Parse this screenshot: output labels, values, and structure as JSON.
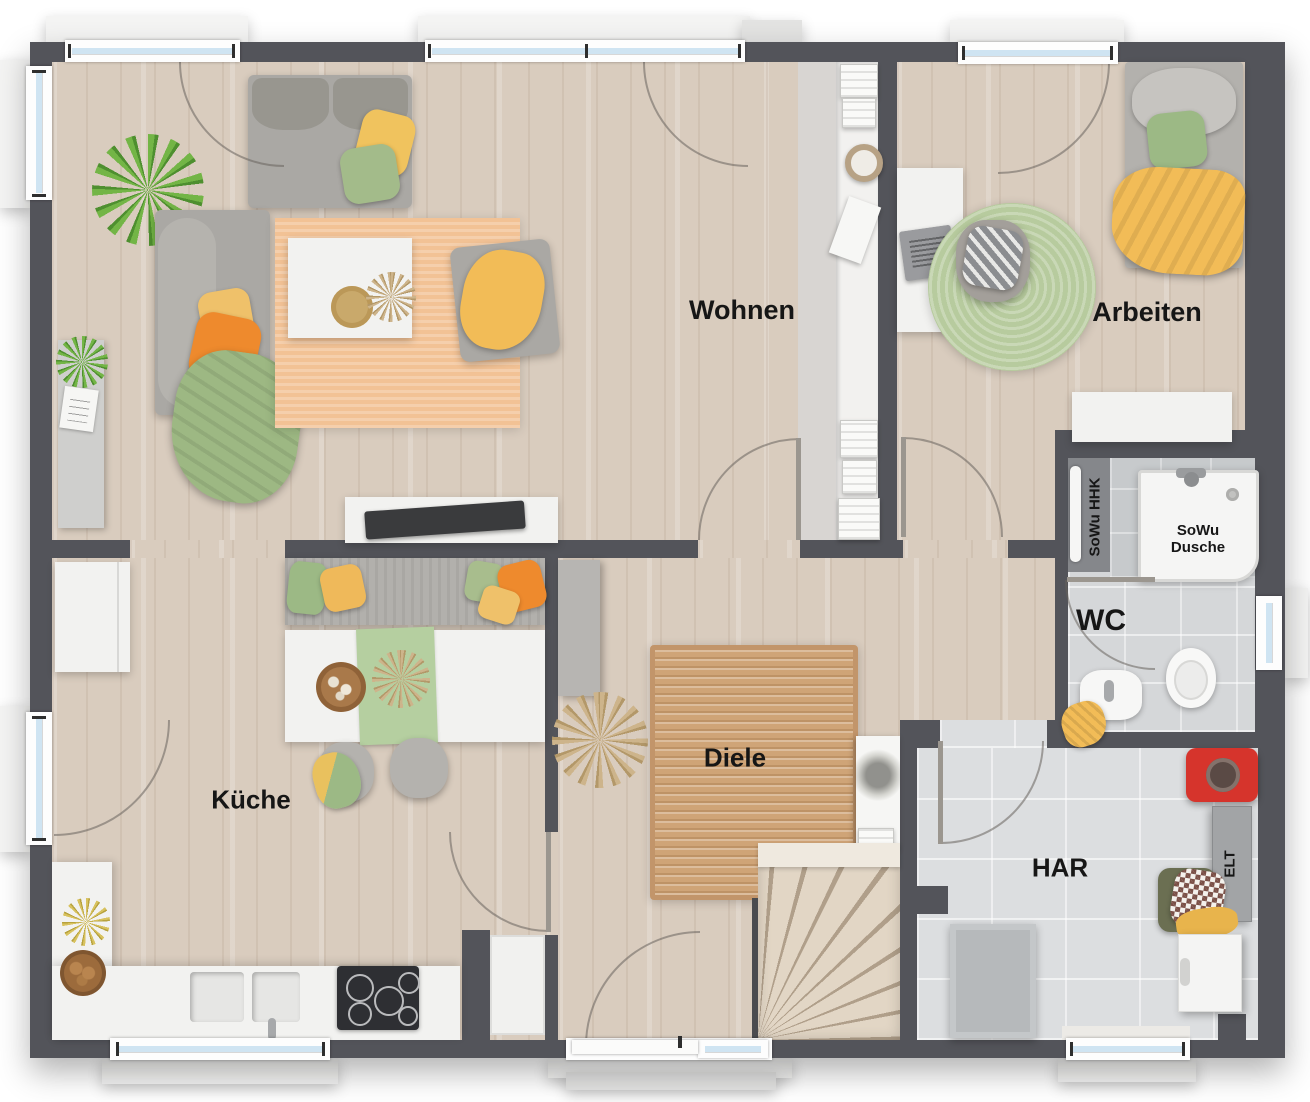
{
  "rooms": {
    "wohnen": {
      "label": "Wohnen"
    },
    "arbeiten": {
      "label": "Arbeiten"
    },
    "kueche": {
      "label": "Küche"
    },
    "diele": {
      "label": "Diele"
    },
    "har": {
      "label": "HAR"
    },
    "wc": {
      "label": "WC"
    }
  },
  "fixtures": {
    "shower_label": "SoWu\nDusche",
    "towel_radiator_label": "SoWu HHK",
    "electrical_cabinet_label": "ELT"
  },
  "colors": {
    "wall": "#53545a",
    "wood": "#d9ccbe",
    "window_glass": "#cfe4f2",
    "rug_orange": "#f2c295",
    "rug_jute": "#cfa477",
    "rug_green": "#b7cb9e",
    "accent_orange": "#ee8a2d",
    "accent_yellow": "#f2bc57",
    "accent_green": "#9cb985",
    "red_item": "#d6342c"
  }
}
